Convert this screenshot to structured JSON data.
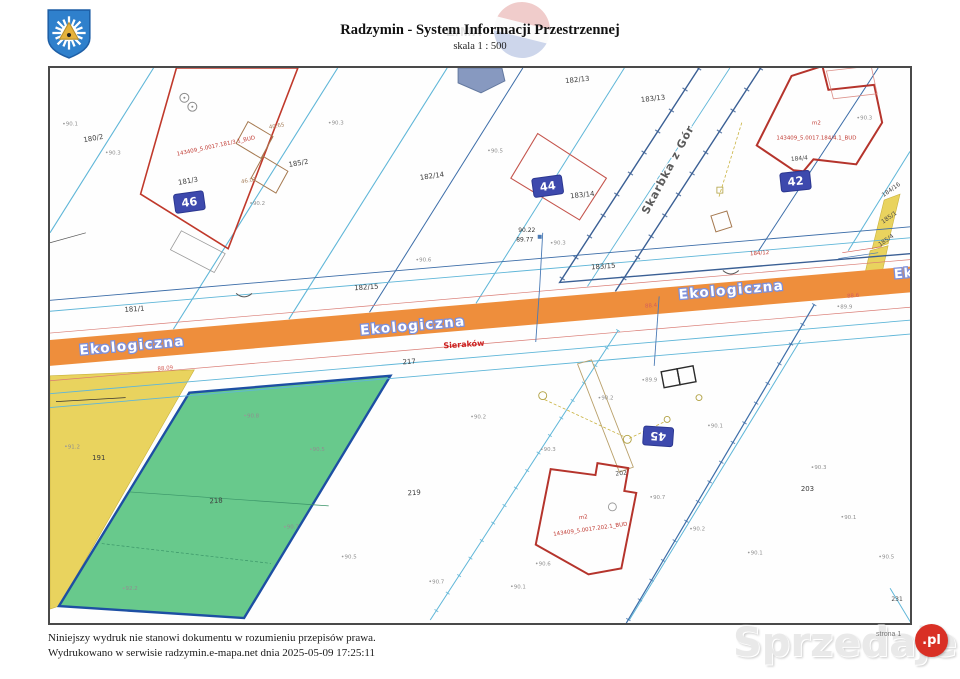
{
  "header": {
    "title": "Radzymin - System Informacji Przestrzennej",
    "subtitle": "skala 1 : 500",
    "watermark_text": "E/MA"
  },
  "footer": {
    "line1": "Niniejszy wydruk nie stanowi dokumentu w rozumieniu przepisów prawa.",
    "line2": "Wydrukowano w serwisie radzymin.e-mapa.net dnia 2025-05-09 17:25:11",
    "page_note": "strona 1"
  },
  "watermark": {
    "text": "Sprzedajemy",
    "suffix": ".pl"
  },
  "colors": {
    "road": "#ee8e3c",
    "green": "#68c98c",
    "greenborder": "#1d4fa3",
    "yellow": "#e9d35e",
    "marker": "#3d49ad",
    "red": "#c0392b",
    "bred": "#b5342c",
    "cyan": "#5fb6d8",
    "steel": "#3c6da8",
    "badge": "#d93025"
  },
  "map": {
    "markers": [
      {
        "t": "46",
        "x": 188,
        "y": 201,
        "r": -8
      },
      {
        "t": "44",
        "x": 548,
        "y": 185,
        "r": -8
      },
      {
        "t": "42",
        "x": 797,
        "y": 180,
        "r": -6
      },
      {
        "t": "45",
        "x": 659,
        "y": 437,
        "r": 184
      }
    ],
    "labels": [
      {
        "t": "Ekologiczna",
        "x": 131,
        "y": 350,
        "r": -5,
        "c": "street"
      },
      {
        "t": "Ekologiczna",
        "x": 413,
        "y": 330,
        "r": -5,
        "c": "street"
      },
      {
        "t": "Ekologiczna",
        "x": 733,
        "y": 294,
        "r": -5,
        "c": "street"
      },
      {
        "t": "Ek",
        "x": 906,
        "y": 277,
        "r": -5,
        "c": "streetEk"
      },
      {
        "t": "Skarbka z Gór",
        "x": 672,
        "y": 170,
        "r": -62,
        "c": "streetdark"
      },
      {
        "t": "180/2",
        "x": 92,
        "y": 139,
        "r": -10,
        "c": "parcel"
      },
      {
        "t": "181/3",
        "x": 187,
        "y": 182,
        "r": -10,
        "c": "parcel"
      },
      {
        "t": "185/2",
        "x": 298,
        "y": 164,
        "r": -10,
        "c": "parcel"
      },
      {
        "t": "182/14",
        "x": 432,
        "y": 177,
        "r": -8,
        "c": "parcel"
      },
      {
        "t": "182/13",
        "x": 578,
        "y": 80,
        "r": -6,
        "c": "parcel"
      },
      {
        "t": "183/13",
        "x": 654,
        "y": 99,
        "r": -6,
        "c": "parcel"
      },
      {
        "t": "183/14",
        "x": 583,
        "y": 196,
        "r": -6,
        "c": "parcel"
      },
      {
        "t": "181/1",
        "x": 133,
        "y": 311,
        "r": -4,
        "c": "parcel"
      },
      {
        "t": "182/15",
        "x": 366,
        "y": 289,
        "r": -4,
        "c": "parcel"
      },
      {
        "t": "183/15",
        "x": 604,
        "y": 268,
        "r": -4,
        "c": "parcel"
      },
      {
        "t": "217",
        "x": 409,
        "y": 364,
        "r": -4,
        "c": "parcel"
      },
      {
        "t": "218",
        "x": 215,
        "y": 504,
        "r": -4,
        "c": "parcel"
      },
      {
        "t": "219",
        "x": 414,
        "y": 496,
        "r": -4,
        "c": "parcel"
      },
      {
        "t": "191",
        "x": 97,
        "y": 461,
        "r": 0,
        "c": "parcel"
      },
      {
        "t": "202",
        "x": 622,
        "y": 476,
        "r": -6,
        "c": "parcelsm"
      },
      {
        "t": "203",
        "x": 809,
        "y": 492,
        "r": 0,
        "c": "parcel"
      },
      {
        "t": "231",
        "x": 899,
        "y": 603,
        "r": 0,
        "c": "parcelsm"
      },
      {
        "t": "184/16",
        "x": 894,
        "y": 190,
        "r": -35,
        "c": "parcelsm"
      },
      {
        "t": "185/1",
        "x": 892,
        "y": 218,
        "r": -35,
        "c": "parcelsm"
      },
      {
        "t": "185/4",
        "x": 889,
        "y": 241,
        "r": -35,
        "c": "parcelsm"
      },
      {
        "t": "184/4",
        "x": 801,
        "y": 159,
        "r": -5,
        "c": "parcelsm"
      },
      {
        "t": "184/12",
        "x": 761,
        "y": 254,
        "r": -4,
        "c": "redcode"
      },
      {
        "t": "143409_5.0017.181/3.1_BUD",
        "x": 215,
        "y": 146,
        "r": -12,
        "c": "redcode"
      },
      {
        "t": "m2",
        "x": 818,
        "y": 123,
        "r": 0,
        "c": "redcode"
      },
      {
        "t": "143409_5.0017.184/4.1_BUD",
        "x": 818,
        "y": 138,
        "r": 0,
        "c": "redcode"
      },
      {
        "t": "m2",
        "x": 584,
        "y": 520,
        "r": -8,
        "c": "redcode"
      },
      {
        "t": "143409_5.0017.202.1_BUD",
        "x": 591,
        "y": 532,
        "r": -8,
        "c": "redcode"
      },
      {
        "t": "Sieraków",
        "x": 464,
        "y": 347,
        "r": -4,
        "c": "redplace"
      },
      {
        "t": "88.09",
        "x": 164,
        "y": 370,
        "r": -5,
        "c": "reddim"
      },
      {
        "t": "88.4",
        "x": 652,
        "y": 307,
        "r": -5,
        "c": "reddim"
      },
      {
        "t": "88.6",
        "x": 855,
        "y": 297,
        "r": -5,
        "c": "reddim"
      },
      {
        "t": "40.65",
        "x": 276,
        "y": 126,
        "r": -10,
        "c": "dim"
      },
      {
        "t": "46.07",
        "x": 248,
        "y": 181,
        "r": -10,
        "c": "dim"
      },
      {
        "t": "90.22",
        "x": 527,
        "y": 231,
        "r": 0,
        "c": "blacksm"
      },
      {
        "t": "89.77",
        "x": 525,
        "y": 241,
        "r": 0,
        "c": "blacksm"
      },
      {
        "t": "90.1",
        "x": 70,
        "y": 124,
        "r": 0,
        "c": "elev"
      },
      {
        "t": "90.3",
        "x": 113,
        "y": 153,
        "r": 0,
        "c": "elev"
      },
      {
        "t": "90.2",
        "x": 258,
        "y": 204,
        "r": 0,
        "c": "elev"
      },
      {
        "t": "90.3",
        "x": 337,
        "y": 123,
        "r": 0,
        "c": "elev"
      },
      {
        "t": "90.5",
        "x": 497,
        "y": 151,
        "r": 0,
        "c": "elev"
      },
      {
        "t": "90.3",
        "x": 868,
        "y": 118,
        "r": 0,
        "c": "elev"
      },
      {
        "t": "89.9",
        "x": 848,
        "y": 308,
        "r": 0,
        "c": "elev"
      },
      {
        "t": "90.6",
        "x": 425,
        "y": 261,
        "r": 0,
        "c": "elev"
      },
      {
        "t": "90.3",
        "x": 560,
        "y": 244,
        "r": 0,
        "c": "elev"
      },
      {
        "t": "89.9",
        "x": 652,
        "y": 382,
        "r": 0,
        "c": "elev"
      },
      {
        "t": "90.2",
        "x": 608,
        "y": 400,
        "r": 0,
        "c": "elev"
      },
      {
        "t": "90.2",
        "x": 480,
        "y": 419,
        "r": 0,
        "c": "elev"
      },
      {
        "t": "90.3",
        "x": 550,
        "y": 452,
        "r": 0,
        "c": "elev"
      },
      {
        "t": "90.1",
        "x": 718,
        "y": 428,
        "r": 0,
        "c": "elev"
      },
      {
        "t": "90.7",
        "x": 660,
        "y": 500,
        "r": 0,
        "c": "elev"
      },
      {
        "t": "90.2",
        "x": 700,
        "y": 532,
        "r": 0,
        "c": "elev"
      },
      {
        "t": "90.1",
        "x": 758,
        "y": 556,
        "r": 0,
        "c": "elev"
      },
      {
        "t": "90.3",
        "x": 822,
        "y": 470,
        "r": 0,
        "c": "elev"
      },
      {
        "t": "90.1",
        "x": 852,
        "y": 520,
        "r": 0,
        "c": "elev"
      },
      {
        "t": "90.6",
        "x": 545,
        "y": 567,
        "r": 0,
        "c": "elev"
      },
      {
        "t": "90.7",
        "x": 438,
        "y": 585,
        "r": 0,
        "c": "elev"
      },
      {
        "t": "90.8",
        "x": 252,
        "y": 418,
        "r": 0,
        "c": "elev"
      },
      {
        "t": "90.5",
        "x": 318,
        "y": 452,
        "r": 0,
        "c": "elev"
      },
      {
        "t": "91.2",
        "x": 72,
        "y": 449,
        "r": 0,
        "c": "elev"
      },
      {
        "t": "90.7",
        "x": 292,
        "y": 530,
        "r": 0,
        "c": "elev"
      },
      {
        "t": "90.5",
        "x": 350,
        "y": 560,
        "r": 0,
        "c": "elev"
      },
      {
        "t": "90.1",
        "x": 520,
        "y": 590,
        "r": 0,
        "c": "elev"
      },
      {
        "t": "92.2",
        "x": 130,
        "y": 592,
        "r": 0,
        "c": "elev"
      },
      {
        "t": "90.5",
        "x": 890,
        "y": 560,
        "r": 0,
        "c": "elev"
      }
    ]
  }
}
